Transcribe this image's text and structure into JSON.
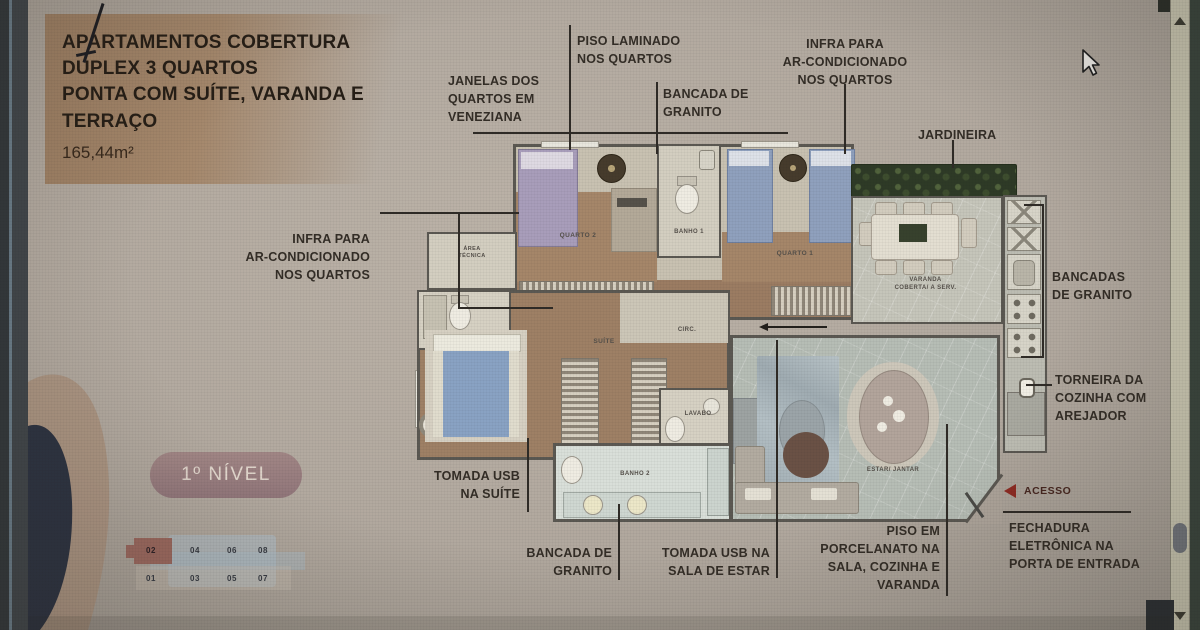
{
  "slide": {
    "title": "APARTAMENTOS COBERTURA\nDUPLEX 3 QUARTOS\nPONTA COM SUÍTE, VARANDA E\nTERRAÇO",
    "area": "165,44m²",
    "level_badge": "1º NÍVEL"
  },
  "annotations": {
    "piso_laminado": "PISO LAMINADO\nNOS QUARTOS",
    "janelas": "JANELAS DOS\nQUARTOS EM\nVENEZIANA",
    "bancada_top": "BANCADA DE\nGRANITO",
    "infra_top": "INFRA PARA\nAR-CONDICIONADO\nNOS QUARTOS",
    "jardineira": "JARDINEIRA",
    "infra_left": "INFRA PARA\nAR-CONDICIONADO\nNOS QUARTOS",
    "tomada_suite": "TOMADA USB\nNA SUÍTE",
    "bancada_bottom": "BANCADA DE\nGRANITO",
    "tomada_sala": "TOMADA USB NA\nSALA DE ESTAR",
    "piso_porcelanato": "PISO EM\nPORCELANATO NA\nSALA, COZINHA E\nVARANDA",
    "bancadas_right": "BANCADAS\nDE GRANITO",
    "torneira": "TORNEIRA DA\nCOZINHA COM\nAREJADOR",
    "acesso": "ACESSO",
    "fechadura": "FECHADURA\nELETRÔNICA NA\nPORTA DE ENTRADA"
  },
  "rooms": {
    "quarto2": "QUARTO 2",
    "banho1": "BANHO 1",
    "quarto1": "QUARTO 1",
    "varanda": "VARANDA\nCOBERTA/ A SERV.",
    "circ": "CIRC.",
    "suite": "SUÍTE",
    "lavabo": "LAVABO",
    "banho2": "BANHO 2",
    "estar": "ESTAR/ JANTAR",
    "cozinha": "COZINHA",
    "area_tecnica": "ÁREA\nTÉCNICA"
  },
  "key_plan": {
    "top_row": [
      "02",
      "04",
      "06",
      "08"
    ],
    "bottom_row": [
      "01",
      "03",
      "05",
      "07"
    ]
  },
  "colors": {
    "accent_red": "#8e2b23",
    "badge_bg": "#9b807e",
    "hedge_green": "#2e3a26",
    "wood_floor": "#a28368",
    "bed_blue": "#8fa0bd",
    "bed_purple": "#a89dba",
    "suite_bed_blue": "#89a2c3"
  }
}
